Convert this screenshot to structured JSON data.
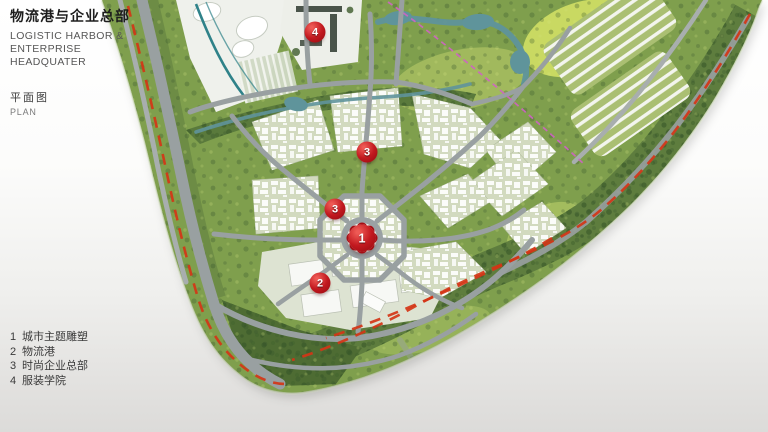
{
  "header": {
    "title_zh": "物流港与企业总部",
    "title_en_line1": "LOGISTIC HARBOR &",
    "title_en_line2": "ENTERPRISE HEADQUATER",
    "plan_zh": "平面图",
    "plan_en": "PLAN"
  },
  "legend": {
    "items": [
      {
        "num": "1",
        "label": "城市主题雕塑"
      },
      {
        "num": "2",
        "label": "物流港"
      },
      {
        "num": "3",
        "label": "时尚企业总部"
      },
      {
        "num": "4",
        "label": "服装学院"
      }
    ]
  },
  "map": {
    "markers": [
      {
        "num": "4",
        "x": 315,
        "y": 32,
        "major": false
      },
      {
        "num": "3",
        "x": 367,
        "y": 152,
        "major": false
      },
      {
        "num": "3",
        "x": 335,
        "y": 209,
        "major": false
      },
      {
        "num": "1",
        "x": 362,
        "y": 238,
        "major": true
      },
      {
        "num": "2",
        "x": 320,
        "y": 283,
        "major": false
      }
    ],
    "colors": {
      "marker_red": "#c2191f",
      "marker_red_dark": "#a50e14",
      "dash_red": "#d43516",
      "dash_magenta": "#cf63c4",
      "road_gray": "#99a0a1",
      "water_teal": "#5f949b",
      "site_green": "#7f9f4d",
      "background_top": "#ffffff",
      "background_bottom": "#dcdbd9"
    }
  }
}
